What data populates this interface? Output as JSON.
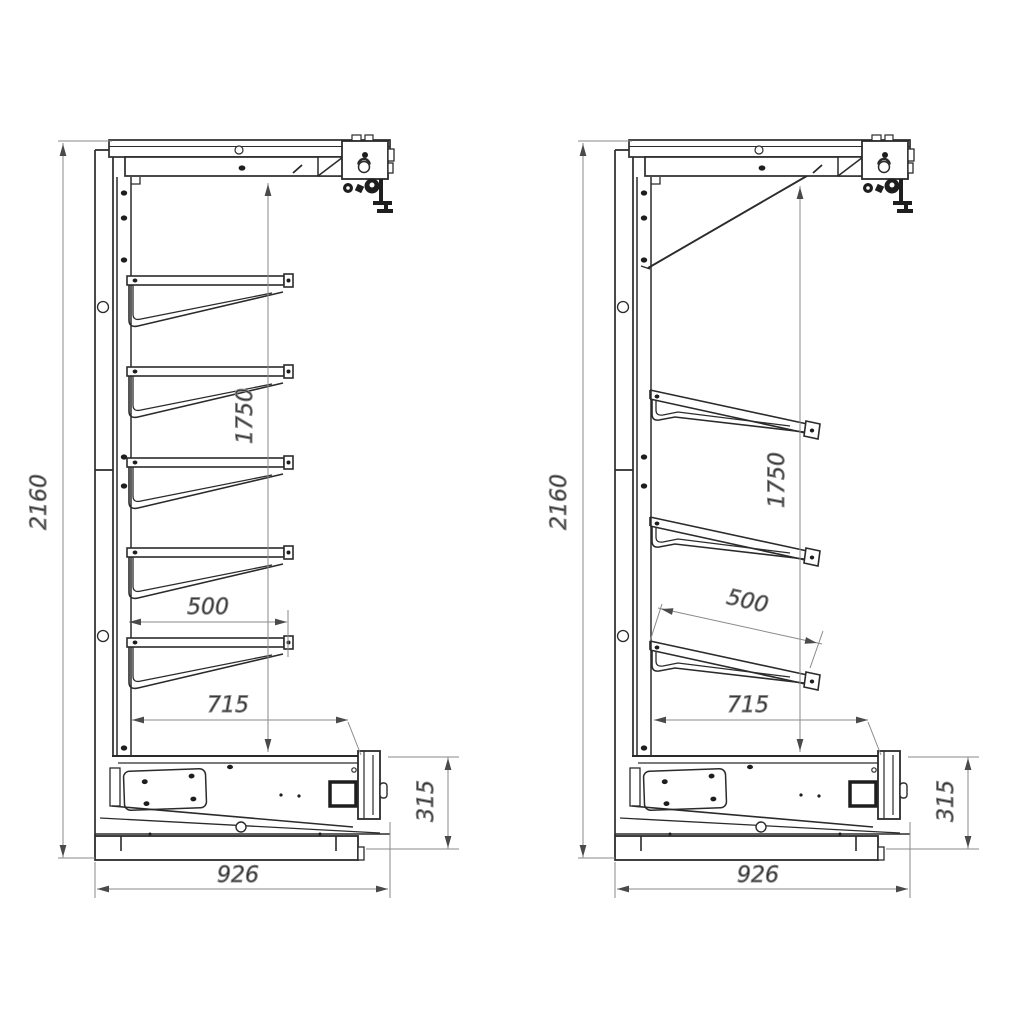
{
  "colors": {
    "background": "#ffffff",
    "line": "#2b2b2b",
    "dim_line": "#8a8a8a",
    "arrow": "#4a4a4a",
    "text": "#2f2f2f"
  },
  "views": {
    "left": {
      "shelf_count": 5,
      "shelf_style": "horizontal",
      "dims": {
        "overall_height": "2160",
        "inner_height": "1750",
        "shelf_depth": "500",
        "shelf_reach": "715",
        "base_height": "315",
        "overall_depth": "926"
      }
    },
    "right": {
      "shelf_count": 3,
      "shelf_style": "inclined",
      "dims": {
        "overall_height": "2160",
        "inner_height": "1750",
        "shelf_depth": "500",
        "shelf_reach": "715",
        "base_height": "315",
        "overall_depth": "926"
      }
    }
  }
}
